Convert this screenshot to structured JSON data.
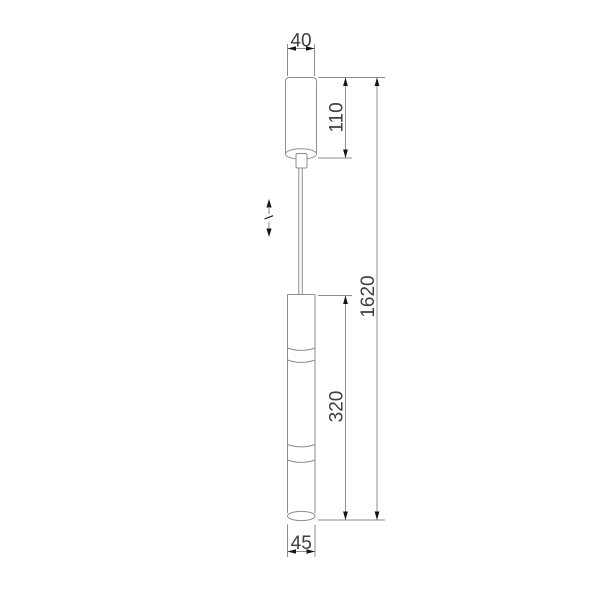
{
  "theme": {
    "bg": "#ffffff",
    "line": "#8d8d8d",
    "arrow": "#161616",
    "text": "#3e3e3e"
  },
  "drawing": {
    "type": "technical-dimension-drawing",
    "subject": "pendant-light-with-ceiling-canopy-and-adjustable-cable",
    "dimensions": {
      "canopy_width": "40",
      "canopy_height": "110",
      "total_height": "1620",
      "body_height": "320",
      "body_diameter": "45"
    }
  }
}
